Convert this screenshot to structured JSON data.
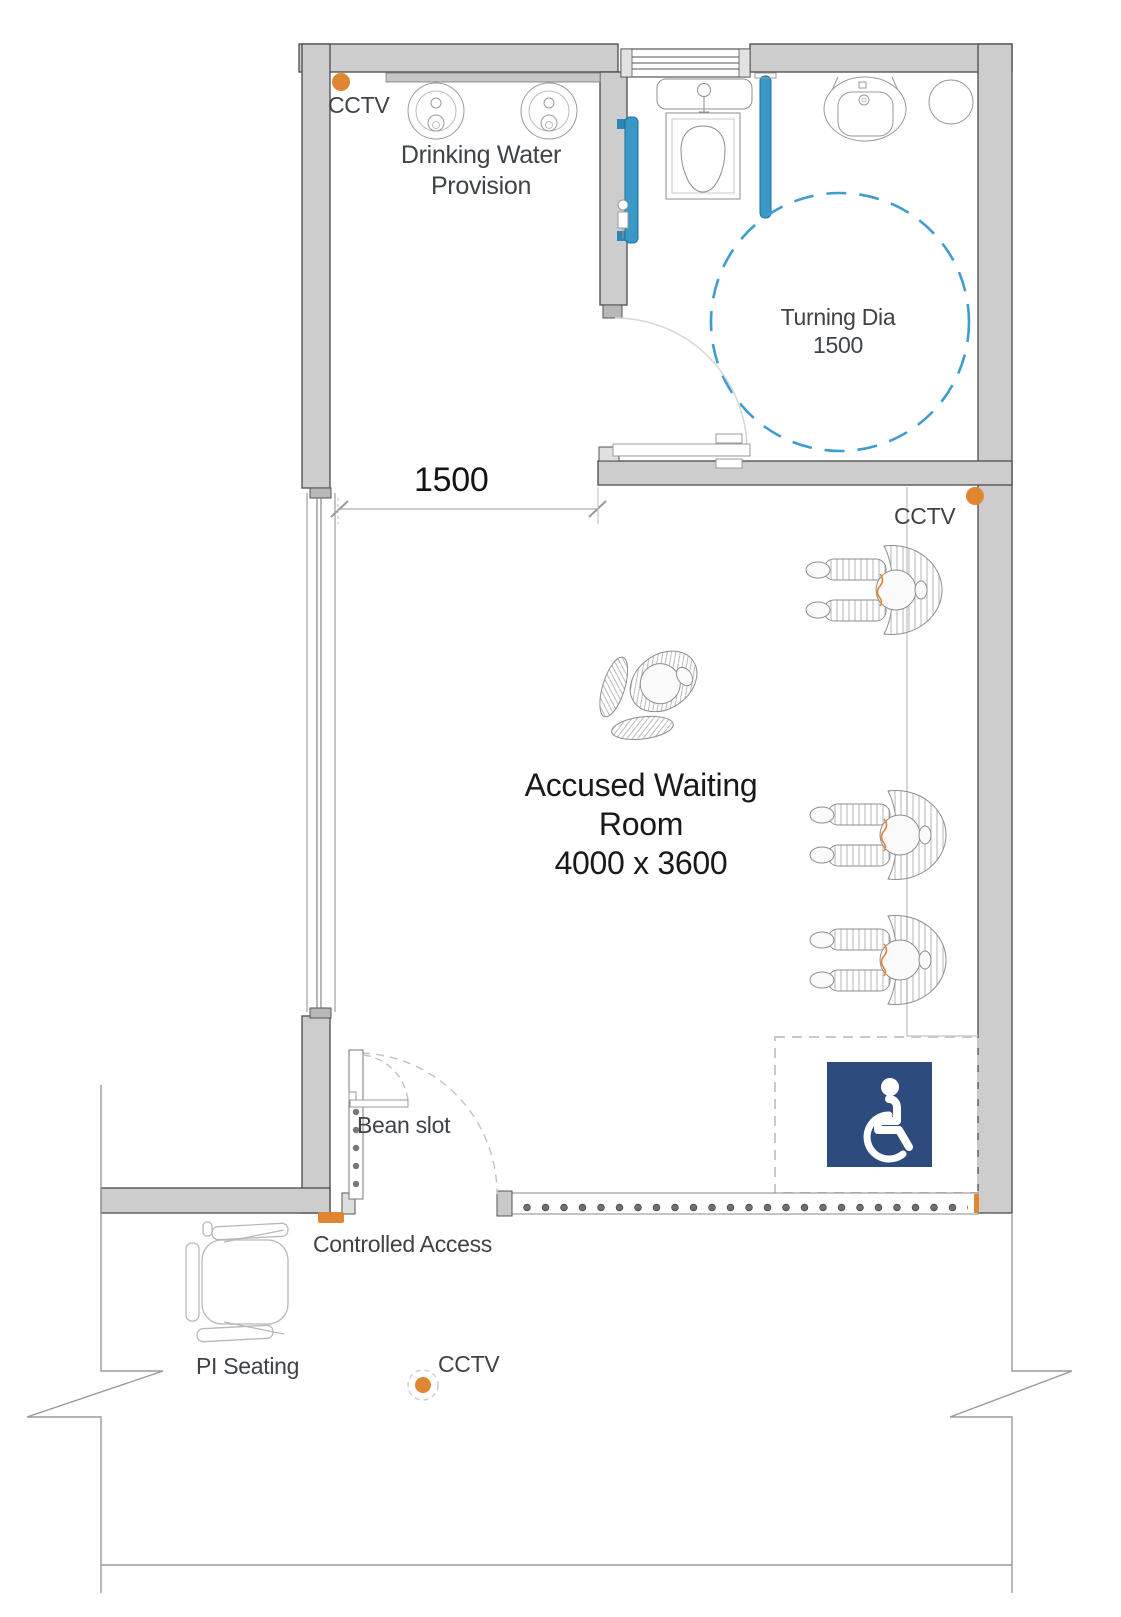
{
  "title": "Accused Waiting Room floor plan",
  "labels": {
    "cctv": "CCTV",
    "drinking_water_1": "Drinking Water",
    "drinking_water_2": "Provision",
    "turning_dia_1": "Turning Dia",
    "turning_dia_2": "1500",
    "door_width": "1500",
    "room_1": "Accused Waiting",
    "room_2": "Room",
    "room_3": "4000 x 3600",
    "bean_slot": "Bean slot",
    "controlled_access": "Controlled Access",
    "pi_seating": "PI Seating"
  },
  "colors": {
    "wall_gray": "#cdcdcd",
    "accent_orange": "#E08633",
    "grab_rail_blue": "#3A98C8",
    "turning_circle_blue": "#3E9CD0",
    "accessible_sign_navy": "#2E4B7E"
  },
  "icons": {
    "cctv_marker": "orange-dot",
    "accessible_sign": "wheelchair-symbol"
  },
  "rooms": [
    {
      "name": "Accused Waiting Room",
      "size": "4000 x 3600"
    },
    {
      "name": "Drinking Water Provision"
    },
    {
      "name": "Accessible washroom",
      "turning_diameter": "1500"
    }
  ]
}
